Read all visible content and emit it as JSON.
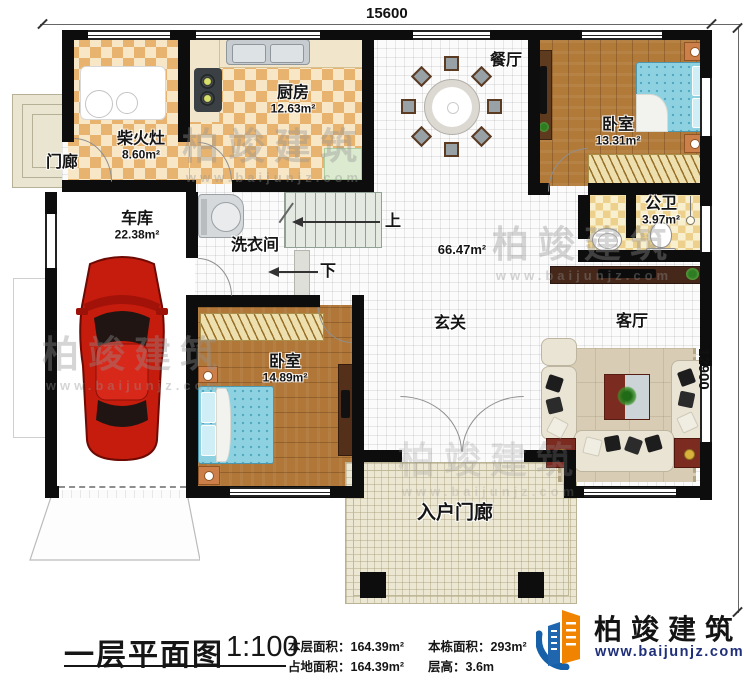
{
  "dimensions": {
    "width_mm": "15600",
    "height_mm": "12900"
  },
  "rooms": {
    "dining": {
      "name": "餐厅"
    },
    "kitchen": {
      "name": "厨房",
      "area": "12.63m²"
    },
    "firewood_stove": {
      "name": "柴火灶",
      "area": "8.60m²"
    },
    "porch": {
      "name": "门廊"
    },
    "bedroom_top": {
      "name": "卧室",
      "area": "13.31m²"
    },
    "bathroom": {
      "name": "公卫",
      "area": "3.97m²"
    },
    "garage": {
      "name": "车库",
      "area": "22.38m²"
    },
    "laundry": {
      "name": "洗衣间"
    },
    "foyer": {
      "name": "玄关",
      "area": "66.47m²"
    },
    "living": {
      "name": "客厅"
    },
    "bedroom_bottom": {
      "name": "卧室",
      "area": "14.89m²"
    },
    "entry_porch": {
      "name": "入户门廊"
    }
  },
  "stairs": {
    "up_label": "上",
    "down_label": "下"
  },
  "footer": {
    "title": "一层平面图",
    "scale": "1:100",
    "items": [
      {
        "label": "本层面积：",
        "value": "164.39m²"
      },
      {
        "label": "占地面积：",
        "value": "164.39m²"
      },
      {
        "label": "本栋面积：",
        "value": "293m²"
      },
      {
        "label": "层高：",
        "value": "3.6m"
      }
    ]
  },
  "brand": {
    "name": "柏竣建筑",
    "website": "www.baijunjz.com"
  },
  "watermark": {
    "name": "柏竣建筑",
    "website": "www.baijunjz.com"
  },
  "colors": {
    "wall": "#0d0d0d",
    "checker_dark": "#e7b36e",
    "wood": "#b27a39",
    "car_red": "#c51c0d",
    "brand_blue": "#1660aa",
    "brand_orange": "#f08300"
  }
}
